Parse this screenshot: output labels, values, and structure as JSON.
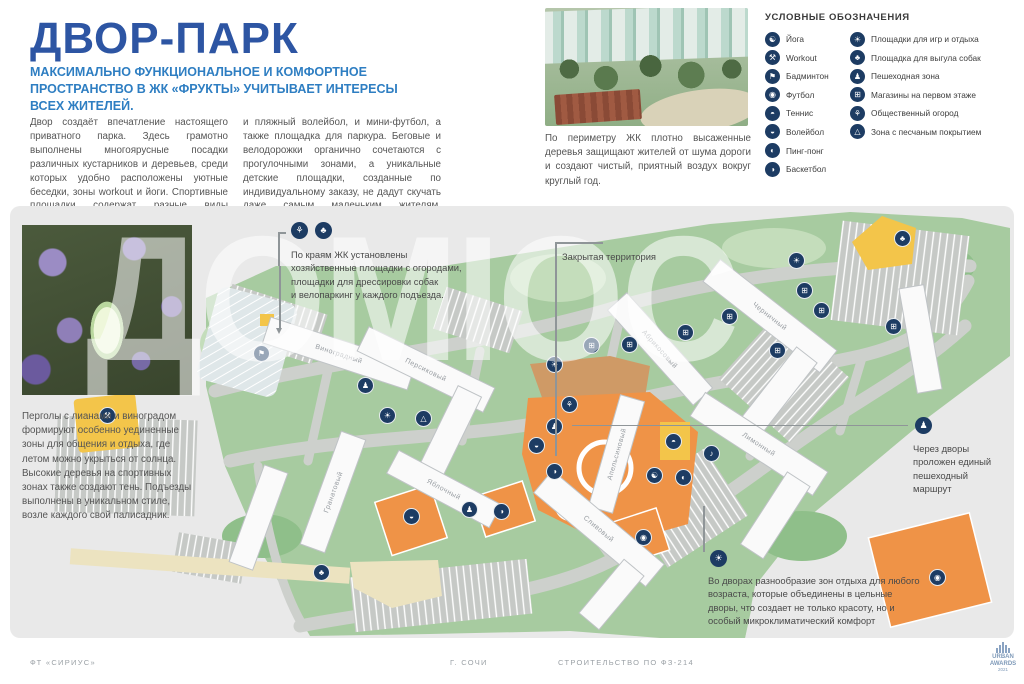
{
  "page": {
    "title": "ДВОР-ПАРК",
    "subtitle": "МАКСИМАЛЬНО ФУНКЦИОНАЛЬНОЕ И КОМФОРТНОЕ ПРОСТРАНСТВО В ЖК «ФРУКТЫ» УЧИТЫВАЕТ ИНТЕРЕСЫ ВСЕХ ЖИТЕЛЕЙ.",
    "intro_col1": "Двор создаёт впечатление настоящего приватного парка. Здесь грамотно выполнены многоярусные посадки различных кустарников и деревьев, среди которых удобно расположены уютные беседки, зоны workout и йоги. Спортивные площадки содержат разные виды активностей. Тут и теннисный корт,",
    "intro_col2": "и пляжный волейбол, и мини-футбол, а также площадка для паркура. Беговые и велодорожки органично сочетаются с прогулочными зонами, а уникальные детские площадки, созданные по индивидуальному заказу, не дадут скучать даже самым маленьким жителям. Велопаркинг у каждого подъезда."
  },
  "aerial_photo": {
    "caption": "По периметру ЖК плотно высаженные деревья защищают жителей от шума дороги и создают чистый, приятный воздух вокруг круглый год."
  },
  "legend": {
    "heading": "УСЛОВНЫЕ ОБОЗНАЧЕНИЯ",
    "columns": [
      [
        {
          "icon": "yoga-icon",
          "glyph": "☯",
          "label": "Йога"
        },
        {
          "icon": "workout-icon",
          "glyph": "⚒",
          "label": "Workout"
        },
        {
          "icon": "badminton-icon",
          "glyph": "⚑",
          "label": "Бадминтон"
        },
        {
          "icon": "football-icon",
          "glyph": "◉",
          "label": "Футбол"
        },
        {
          "icon": "tennis-icon",
          "glyph": "◓",
          "label": "Теннис"
        },
        {
          "icon": "volleyball-icon",
          "glyph": "◒",
          "label": "Волейбол"
        },
        {
          "icon": "pingpong-icon",
          "glyph": "◐",
          "label": "Пинг-понг"
        },
        {
          "icon": "basketball-icon",
          "glyph": "◑",
          "label": "Баскетбол"
        }
      ],
      [
        {
          "icon": "playground-icon",
          "glyph": "☀",
          "label": "Площадки для игр и отдыха"
        },
        {
          "icon": "dog-walking-icon",
          "glyph": "♣",
          "label": "Площадка для выгула собак"
        },
        {
          "icon": "pedestrian-icon",
          "glyph": "♟",
          "label": "Пешеходная зона"
        },
        {
          "icon": "shops-icon",
          "glyph": "⊞",
          "label": "Магазины на первом этаже"
        },
        {
          "icon": "garden-icon",
          "glyph": "⚘",
          "label": "Общественный огород"
        },
        {
          "icon": "sand-icon",
          "glyph": "△",
          "label": "Зона с песчаным покрытием"
        }
      ]
    ]
  },
  "pergola": {
    "text": "Перголы с лианами и виноградом формируют особенно уединенные зоны для общения и отдыха, где летом можно укрыться от солнца. Высокие деревья на спортивных зонах также создают тень. Подъезды выполнены в уникальном стиле, возле каждого свой палисадник."
  },
  "map": {
    "watermark": "ДОМІОС",
    "callouts": {
      "edges": "По краям ЖК установлены\nхозяйственные площадки с огородами,\nплощадки для дрессировки собак\nи велопаркинг у каждого подъезда.",
      "closed_territory": "Закрытая территория",
      "route": "Через дворы\nпроложен единый\nпешеходный\nмаршрут",
      "courtyards": "Во дворах разнообразие зон отдыха для любого\nвозраста, которые объединены в цельные\nдворы, что создает не только красоту, но и\nособый микроклиматический комфорт"
    },
    "buildings": [
      {
        "label": "Виноградный",
        "x": 253,
        "y": 134,
        "w": 152,
        "h": 27,
        "r": 18
      },
      {
        "label": "Персиковый",
        "x": 346,
        "y": 150,
        "w": 140,
        "h": 27,
        "r": 26,
        "arm": {
          "x": 452,
          "y": 164,
          "w": 26,
          "h": 92
        }
      },
      {
        "label": "Черничный",
        "x": 686,
        "y": 96,
        "w": 148,
        "h": 28,
        "r": 38,
        "arm": {
          "x": 800,
          "y": 118,
          "w": 26,
          "h": 95
        }
      },
      {
        "label": "",
        "x": 898,
        "y": 80,
        "w": 25,
        "h": 106,
        "r": -10
      },
      {
        "label": "Абрикосовый",
        "x": 586,
        "y": 130,
        "w": 128,
        "h": 26,
        "r": 48
      },
      {
        "label": "Апельсиновый",
        "x": 594,
        "y": 190,
        "w": 25,
        "h": 116,
        "r": 16
      },
      {
        "label": "Лимонный",
        "x": 676,
        "y": 224,
        "w": 146,
        "h": 28,
        "r": 33,
        "arm": {
          "x": 788,
          "y": 246,
          "w": 27,
          "h": 86
        }
      },
      {
        "label": "Гранатовый",
        "x": 310,
        "y": 226,
        "w": 26,
        "h": 120,
        "r": 20
      },
      {
        "label": "Яблочный",
        "x": 376,
        "y": 270,
        "w": 116,
        "h": 26,
        "r": 28
      },
      {
        "label": "Сливовый",
        "x": 516,
        "y": 308,
        "w": 146,
        "h": 29,
        "r": 40,
        "arm": {
          "x": 628,
          "y": 330,
          "w": 26,
          "h": 70
        }
      },
      {
        "label": "",
        "x": 236,
        "y": 260,
        "w": 25,
        "h": 103,
        "r": 20
      },
      {
        "label": "",
        "x": 68,
        "y": 116,
        "w": 108,
        "h": 25,
        "r": 15
      }
    ],
    "icons": [
      {
        "t": "workout-icon",
        "g": "⚒",
        "x": 98,
        "y": 210
      },
      {
        "t": "badminton-icon",
        "g": "⚑",
        "x": 252,
        "y": 148
      },
      {
        "t": "pedestrian-icon",
        "g": "♟",
        "x": 356,
        "y": 180
      },
      {
        "t": "playground-icon",
        "g": "☀",
        "x": 378,
        "y": 210
      },
      {
        "t": "sand-icon",
        "g": "△",
        "x": 414,
        "y": 213
      },
      {
        "t": "shops-icon",
        "g": "⊞",
        "x": 582,
        "y": 140
      },
      {
        "t": "shops-icon",
        "g": "⊞",
        "x": 620,
        "y": 139
      },
      {
        "t": "shops-icon",
        "g": "⊞",
        "x": 676,
        "y": 127
      },
      {
        "t": "shops-icon",
        "g": "⊞",
        "x": 720,
        "y": 111
      },
      {
        "t": "shops-icon",
        "g": "⊞",
        "x": 795,
        "y": 85
      },
      {
        "t": "shops-icon",
        "g": "⊞",
        "x": 812,
        "y": 105
      },
      {
        "t": "shops-icon",
        "g": "⊞",
        "x": 768,
        "y": 145
      },
      {
        "t": "shops-icon",
        "g": "⊞",
        "x": 884,
        "y": 121
      },
      {
        "t": "dog-walking-icon",
        "g": "♣",
        "x": 893,
        "y": 33
      },
      {
        "t": "dog-walking-icon",
        "g": "♣",
        "x": 312,
        "y": 367
      },
      {
        "t": "pedestrian-icon",
        "g": "♟",
        "x": 460,
        "y": 304
      },
      {
        "t": "pedestrian-icon",
        "g": "♟",
        "x": 545,
        "y": 221
      },
      {
        "t": "playground-icon",
        "g": "☀",
        "x": 545,
        "y": 159
      },
      {
        "t": "garden-icon",
        "g": "⚘",
        "x": 560,
        "y": 199
      },
      {
        "t": "volleyball-icon",
        "g": "◒",
        "x": 527,
        "y": 240
      },
      {
        "t": "basketball-icon",
        "g": "◑",
        "x": 545,
        "y": 266
      },
      {
        "t": "yoga-icon",
        "g": "☯",
        "x": 645,
        "y": 270
      },
      {
        "t": "pingpong-icon",
        "g": "◐",
        "x": 674,
        "y": 272
      },
      {
        "t": "music-icon",
        "g": "♪",
        "x": 702,
        "y": 248
      },
      {
        "t": "tennis-icon",
        "g": "◓",
        "x": 664,
        "y": 236
      },
      {
        "t": "volleyball-icon",
        "g": "◒",
        "x": 402,
        "y": 311
      },
      {
        "t": "basketball-icon",
        "g": "◑",
        "x": 492,
        "y": 306
      },
      {
        "t": "football-icon",
        "g": "◉",
        "x": 634,
        "y": 332
      },
      {
        "t": "football-icon",
        "g": "◉",
        "x": 928,
        "y": 372
      },
      {
        "t": "playground-icon",
        "g": "☀",
        "x": 787,
        "y": 55
      }
    ]
  },
  "footer": {
    "left": "ФТ «СИРИУС»",
    "city": "Г. СОЧИ",
    "law": "СТРОИТЕЛЬСТВО ПО ФЗ-214",
    "award_line1": "URBAN",
    "award_line2": "AWARDS",
    "award_year": "2021"
  },
  "colors": {
    "title_blue": "#2d55a3",
    "subtitle_blue": "#2e7ec2",
    "icon_navy": "#1d3c63",
    "map_green": "#a7cba0",
    "orange": "#ef9347",
    "yellow": "#f3c54a"
  }
}
